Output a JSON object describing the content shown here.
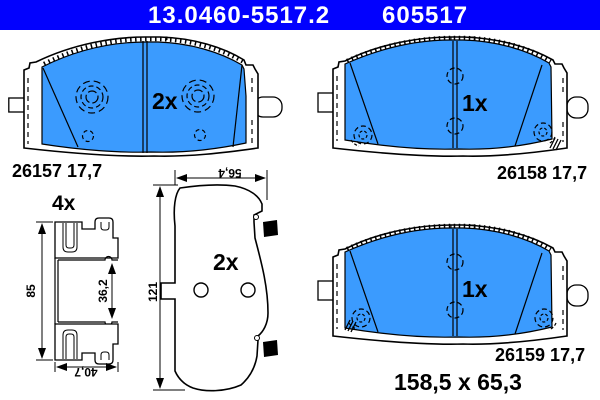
{
  "header": {
    "part_number": "13.0460-5517.2",
    "sku": "605517"
  },
  "colors": {
    "background": "#FFFFFF",
    "header_bar": "#0201FE",
    "header_text": "#FFFFFF",
    "pad_fill": "#3B9BFE",
    "line": "#000000"
  },
  "drawings": {
    "pad_top_left": {
      "quantity": "2x",
      "label": "26157 17,7"
    },
    "pad_top_right": {
      "quantity": "1x",
      "label": "26158 17,7"
    },
    "pad_bottom_right": {
      "quantity": "1x",
      "label": "26159 17,7",
      "size": "158,5 x 65,3"
    },
    "pad_side_view": {
      "quantity": "2x",
      "dim_width": "56,4",
      "dim_height": "121"
    },
    "accessory_clip": {
      "quantity": "4x",
      "dim_height": "85",
      "dim_inner": "36,2",
      "dim_width": "40,7"
    }
  }
}
